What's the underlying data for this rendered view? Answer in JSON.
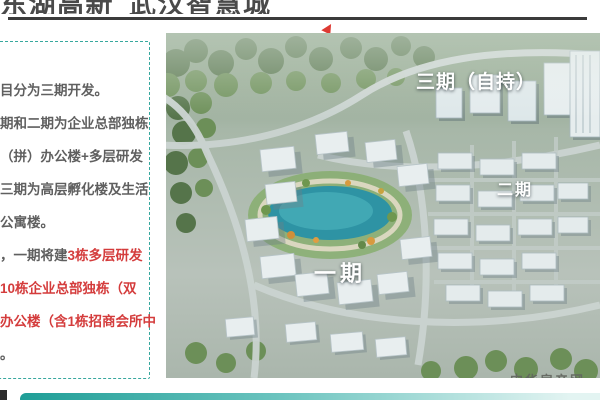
{
  "header": {
    "title": "东湖高新 武汉智慧城"
  },
  "sidebar": {
    "lines": [
      "目分为三期开发。",
      "期和二期为企业总部独栋",
      "（拼）办公楼+多层研发",
      "三期为高层孵化楼及生活",
      "公寓楼。"
    ],
    "para2_prefix": "，一期将建",
    "para2_red1": "3栋多层研发",
    "para2_red2": "10栋企业总部独栋（双",
    "para2_red3": "办公楼（含1栋招商会所中",
    "para2_tail": "。"
  },
  "image": {
    "labels": [
      "三期（自持）",
      "二期",
      "一期"
    ],
    "watermark": "中华房产网",
    "features": [
      "central-lake",
      "office-park-buildings",
      "forest-belt",
      "ring-roads"
    ]
  },
  "colors": {
    "title_dark": "#4a4a4a",
    "rule_dark": "#3b3b3b",
    "body_gray": "#5f5f5f",
    "accent_red": "#d43c3c",
    "dashed_teal": "#38a89e",
    "bar_teal": "#1f9e97",
    "lake_teal": "#2e93a4"
  }
}
